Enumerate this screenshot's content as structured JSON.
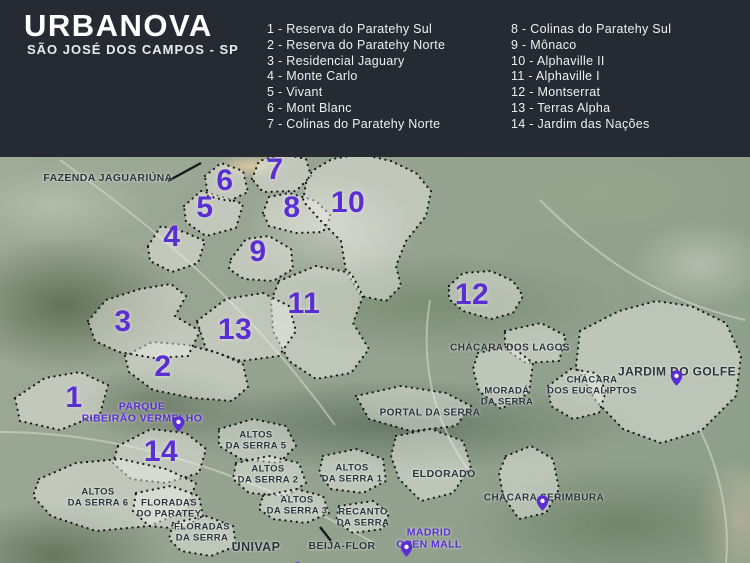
{
  "header": {
    "title": "URBANOVA",
    "subtitle": "SÃO JOSÉ DOS CAMPOS - SP",
    "legend_col1": [
      "1 - Reserva do Paratehy Sul",
      "2 - Reserva do Paratehy Norte",
      "3 - Residencial Jaguary",
      "4 - Monte Carlo",
      "5 - Vivant",
      "6 - Mont Blanc",
      "7 - Colinas do Paratehy Norte"
    ],
    "legend_col2": [
      "8 - Colinas do Paratehy Sul",
      "9 - Mônaco",
      "10 - Alphaville II",
      "11 - Alphaville I",
      "12 - Montserrat",
      "13 - Terras Alpha",
      "14 - Jardim das Nações"
    ]
  },
  "colors": {
    "header_bg": "#262b33",
    "accent_purple": "#5a2ed2",
    "label_dark": "#2c333b"
  },
  "map": {
    "region_numbers": [
      {
        "n": "1",
        "x": 74,
        "y": 398
      },
      {
        "n": "2",
        "x": 163,
        "y": 367
      },
      {
        "n": "3",
        "x": 123,
        "y": 322
      },
      {
        "n": "4",
        "x": 172,
        "y": 237
      },
      {
        "n": "5",
        "x": 205,
        "y": 208
      },
      {
        "n": "6",
        "x": 225,
        "y": 181
      },
      {
        "n": "7",
        "x": 275,
        "y": 170
      },
      {
        "n": "8",
        "x": 292,
        "y": 208
      },
      {
        "n": "9",
        "x": 258,
        "y": 252
      },
      {
        "n": "10",
        "x": 348,
        "y": 203
      },
      {
        "n": "11",
        "x": 304,
        "y": 304
      },
      {
        "n": "12",
        "x": 472,
        "y": 295
      },
      {
        "n": "13",
        "x": 235,
        "y": 330
      },
      {
        "n": "14",
        "x": 161,
        "y": 452
      }
    ],
    "labels": [
      {
        "id": "fazenda-jaguariuna-label",
        "lines": [
          "FAZENDA JAGUARIÚNA"
        ],
        "x": 108,
        "y": 179,
        "size": 10.5,
        "color": "dark"
      },
      {
        "id": "chacara-dos-lagos-label",
        "lines": [
          "CHÁCARA DOS LAGOS"
        ],
        "x": 510,
        "y": 348,
        "size": 10,
        "color": "dark"
      },
      {
        "id": "jardim-do-golfe-label",
        "lines": [
          "JARDIM DO GOLFE"
        ],
        "x": 677,
        "y": 372,
        "size": 12,
        "color": "dark"
      },
      {
        "id": "chacara-dos-eucaliptos-label",
        "lines": [
          "CHÁCARA",
          "DOS EUCALIPTOS"
        ],
        "x": 592,
        "y": 386,
        "size": 9.5,
        "color": "dark"
      },
      {
        "id": "morada-da-serra-label",
        "lines": [
          "MORADÁ",
          "DA SERRA"
        ],
        "x": 507,
        "y": 397,
        "size": 9.5,
        "color": "dark"
      },
      {
        "id": "portal-da-serra-label",
        "lines": [
          "PORTAL DA SERRA"
        ],
        "x": 430,
        "y": 413,
        "size": 10,
        "color": "dark"
      },
      {
        "id": "eldorado-label",
        "lines": [
          "ELDORADO"
        ],
        "x": 444,
        "y": 475,
        "size": 10.5,
        "color": "dark"
      },
      {
        "id": "altos-da-serra-5-label",
        "lines": [
          "ALTOS",
          "DA SERRA 5"
        ],
        "x": 256,
        "y": 441,
        "size": 9.5,
        "color": "dark"
      },
      {
        "id": "altos-da-serra-2-label",
        "lines": [
          "ALTOS",
          "DA SERRA 2"
        ],
        "x": 268,
        "y": 475,
        "size": 9.5,
        "color": "dark"
      },
      {
        "id": "altos-da-serra-1-label",
        "lines": [
          "ALTOS",
          "DA SERRA 1"
        ],
        "x": 352,
        "y": 474,
        "size": 9.5,
        "color": "dark"
      },
      {
        "id": "altos-da-serra-6-label",
        "lines": [
          "ALTOS",
          "DA SERRA 6"
        ],
        "x": 98,
        "y": 498,
        "size": 9.5,
        "color": "dark"
      },
      {
        "id": "altos-da-serra-3-label",
        "lines": [
          "ALTOS",
          "DA SERRA 3"
        ],
        "x": 297,
        "y": 506,
        "size": 9.5,
        "color": "dark"
      },
      {
        "id": "floradas-do-paratey-label",
        "lines": [
          "FLORADAS",
          "DO PARATEY"
        ],
        "x": 169,
        "y": 509,
        "size": 9.5,
        "color": "dark"
      },
      {
        "id": "floradas-da-serra-label",
        "lines": [
          "FLORADAS",
          "DA SERRA"
        ],
        "x": 202,
        "y": 533,
        "size": 9.5,
        "color": "dark"
      },
      {
        "id": "recanto-da-serra-label",
        "lines": [
          "RECANTO",
          "DA SERRA"
        ],
        "x": 363,
        "y": 518,
        "size": 9.5,
        "color": "dark"
      },
      {
        "id": "chacara-serimbura-label",
        "lines": [
          "CHÁCARA SERIMBURA"
        ],
        "x": 544,
        "y": 498,
        "size": 10,
        "color": "dark"
      },
      {
        "id": "univap-label",
        "lines": [
          "UNIVAP"
        ],
        "x": 256,
        "y": 547,
        "size": 12.5,
        "color": "dark"
      },
      {
        "id": "beija-flor-label",
        "lines": [
          "BEIJA-FLOR"
        ],
        "x": 342,
        "y": 547,
        "size": 10.5,
        "color": "dark"
      },
      {
        "id": "parque-ribeirao-vermelho-label",
        "lines": [
          "PARQUE",
          "RIBEIRÃO VERMELHO"
        ],
        "x": 142,
        "y": 413,
        "size": 10.5,
        "color": "purple"
      },
      {
        "id": "madrid-open-mall-label",
        "lines": [
          "MADRID",
          "OPEN MALL"
        ],
        "x": 429,
        "y": 539,
        "size": 10.5,
        "color": "purple"
      }
    ],
    "pins": [
      {
        "id": "parque-ribeirao-vermelho-pin",
        "x": 170,
        "y": 413
      },
      {
        "id": "jardim-do-golfe-pin",
        "x": 668,
        "y": 367
      },
      {
        "id": "chacara-serimbura-pin",
        "x": 534,
        "y": 492
      },
      {
        "id": "madrid-open-mall-pin",
        "x": 398,
        "y": 538
      },
      {
        "id": "univap-pin",
        "x": 289,
        "y": 559
      }
    ],
    "regions": [
      {
        "id": "reserva-do-paratehy-sul",
        "points": "15,398 45,378 80,372 108,385 100,414 60,430 20,421"
      },
      {
        "id": "reserva-do-paratehy-norte",
        "points": "125,356 152,342 188,345 218,353 243,364 248,387 232,401 193,398 153,390 129,372"
      },
      {
        "id": "residencial-jaguary",
        "points": "88,321 106,300 140,289 171,284 186,296 175,316 200,331 188,356 154,358 119,352 95,341"
      },
      {
        "id": "monte-carlo",
        "points": "148,246 161,226 184,232 205,241 198,263 172,272 150,261"
      },
      {
        "id": "vivant",
        "points": "184,206 201,191 226,198 243,204 236,228 206,236 186,222"
      },
      {
        "id": "mont-blanc",
        "points": "205,176 221,163 243,171 248,192 229,201 208,196"
      },
      {
        "id": "colinas-do-paratehy-norte",
        "points": "252,179 259,161 283,154 306,159 311,176 296,191 263,192"
      },
      {
        "id": "colinas-do-paratehy-sul",
        "points": "263,213 269,197 289,193 316,201 331,216 323,232 296,233 269,226"
      },
      {
        "id": "monaco",
        "points": "231,259 246,239 269,236 291,249 293,269 273,281 244,279 229,269"
      },
      {
        "id": "alphaville-2",
        "points": "306,183 312,171 332,159 361,154 391,161 416,173 431,191 426,216 406,241 396,266 401,286 386,301 361,296 346,271 341,241 321,221 303,201"
      },
      {
        "id": "alphaville-1",
        "points": "279,281 316,266 351,273 363,296 353,323 369,349 351,373 316,379 289,361 273,331 271,301"
      },
      {
        "id": "montserrat",
        "points": "449,286 463,273 491,271 513,281 523,296 513,313 491,319 463,311 449,299"
      },
      {
        "id": "terras-alpha",
        "points": "197,321 226,299 263,293 289,306 296,331 279,356 241,361 206,349"
      },
      {
        "id": "jardim-das-nacoes",
        "points": "118,446 151,429 186,433 206,449 199,473 166,483 131,479 113,463"
      },
      {
        "id": "jardim-do-golfe",
        "points": "580,331 619,311 656,301 691,306 726,323 741,356 736,396 701,431 661,443 623,429 596,401 576,366"
      },
      {
        "id": "chacara-dos-eucaliptos",
        "points": "548,386 571,369 596,373 606,391 599,413 573,419 551,406"
      },
      {
        "id": "chacara-dos-lagos",
        "points": "505,331 541,323 566,336 559,361 526,363 505,349"
      },
      {
        "id": "morada-da-serra",
        "points": "478,353 511,346 533,363 529,393 501,409 479,391 473,369"
      },
      {
        "id": "portal-da-serra",
        "points": "356,396 401,386 446,393 471,406 456,426 411,431 369,419"
      },
      {
        "id": "eldorado",
        "points": "396,436 431,429 463,441 471,466 453,493 421,501 399,479 391,456"
      },
      {
        "id": "chacara-serimbura",
        "points": "506,456 531,446 553,459 559,489 546,513 519,519 503,496 499,473"
      },
      {
        "id": "altos-da-serra-5",
        "points": "219,429 253,419 286,426 296,446 279,463 241,459 219,446"
      },
      {
        "id": "altos-da-serra-2",
        "points": "236,463 269,456 299,463 306,483 286,496 249,493 233,479"
      },
      {
        "id": "altos-da-serra-1",
        "points": "323,456 356,449 383,459 386,481 363,493 331,489 319,473"
      },
      {
        "id": "altos-da-serra-6",
        "points": "39,479 76,463 121,459 166,469 196,483 186,511 149,526 96,531 51,516 33,496"
      },
      {
        "id": "altos-da-serra-3",
        "points": "263,496 296,489 323,496 329,513 306,523 273,519 259,509"
      },
      {
        "id": "floradas-do-paratey",
        "points": "136,493 171,486 199,496 203,516 181,529 149,526 133,511"
      },
      {
        "id": "floradas-da-serra",
        "points": "173,523 206,516 233,526 236,546 211,556 181,551 169,539"
      },
      {
        "id": "recanto-da-serra",
        "points": "339,506 373,501 389,513 383,529 353,533 336,521"
      }
    ],
    "pointer_lines": [
      {
        "id": "fazenda-pointer-line",
        "x1": 168,
        "y1": 181,
        "x2": 201,
        "y2": 163
      },
      {
        "id": "beija-flor-pointer-line",
        "x1": 320,
        "y1": 527,
        "x2": 331,
        "y2": 541
      }
    ]
  }
}
